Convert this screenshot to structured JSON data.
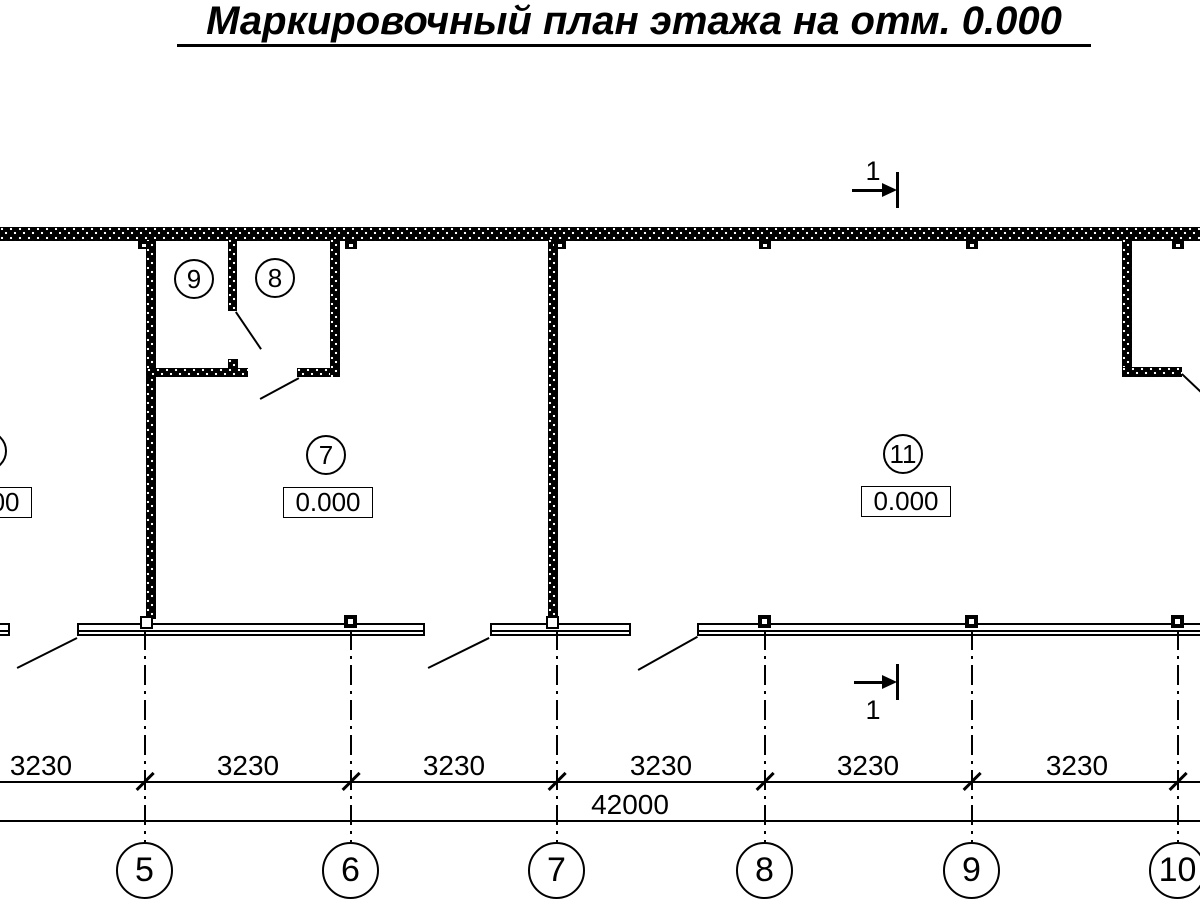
{
  "title": "Маркировочный план этажа на отм. 0.000",
  "rooms": [
    {
      "number": "9"
    },
    {
      "number": "8"
    },
    {
      "number": "7",
      "elevation": "0.000"
    },
    {
      "number": "11",
      "elevation": "0.000"
    }
  ],
  "left_partial": {
    "elevation": "0.000"
  },
  "section_marks": {
    "top": "1",
    "bottom": "1"
  },
  "dimensions": {
    "segments": [
      "3230",
      "3230",
      "3230",
      "3230",
      "3230",
      "3230"
    ],
    "total": "42000"
  },
  "grid_axes": [
    "5",
    "6",
    "7",
    "8",
    "9",
    "10"
  ]
}
